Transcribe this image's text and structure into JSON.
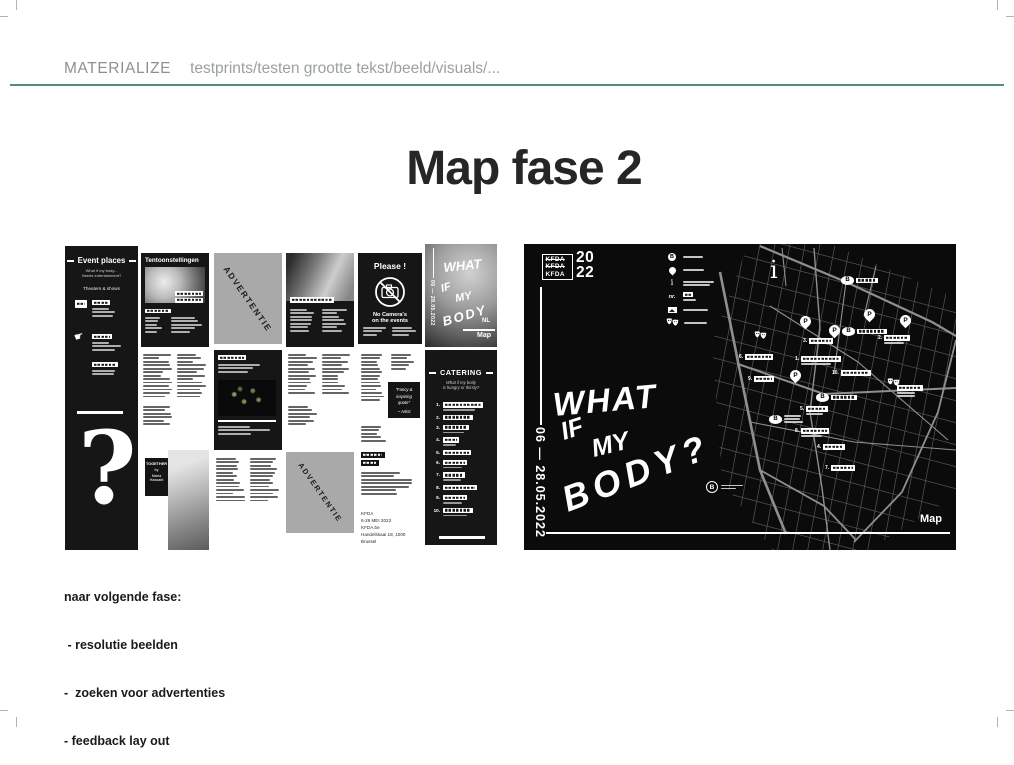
{
  "page": {
    "header": {
      "label": "MATERIALIZE",
      "breadcrumb": "testprints/testen grootte tekst/beeld/visuals/..."
    },
    "title": "Map fase 2",
    "accent_color": "#578c7c",
    "notes": {
      "heading": "naar volgende fase:",
      "items": [
        " - resolutie beelden",
        "-  zoeken voor advertenties",
        "- feedback lay out"
      ]
    }
  },
  "brochure": {
    "event_places": {
      "title": "Event places",
      "subtitle1": "What if my body...",
      "subtitle2": "Needs entertainment?",
      "section": "Theaters & shows",
      "question_mark": "?",
      "hand_glyph": "☛"
    },
    "tentoonstellingen": {
      "title": "Tentoonstellingen"
    },
    "advertentie_label": "ADVERTENTIE",
    "please": {
      "title": "Please !",
      "no_camera_line1": "No Camera's",
      "no_camera_line2": "on the events"
    },
    "cover": {
      "words": [
        "WHAT",
        "IF",
        "MY",
        "BODY"
      ],
      "dates": "06 — 28.05.2022",
      "lang": "NL",
      "map_label": "Map"
    },
    "together": {
      "lines": [
        "TOGETHER",
        "by",
        "Maria",
        "Hassabi"
      ]
    },
    "quote": {
      "line1": "\"Fancy &",
      "line2": "inspiring",
      "line3": "quote\"",
      "author": "~ Artist"
    },
    "catering": {
      "title": "CATERING",
      "subtitle1": "What if my body",
      "subtitle2": "is hungry or thirsty?",
      "numbers": [
        "1.",
        "2.",
        "3.",
        "4.",
        "5.",
        "6.",
        "7.",
        "8.",
        "9.",
        "10."
      ]
    },
    "info": {
      "org": "KFDA",
      "dates": "6-28 MEI 2022",
      "site": "KFDA.be",
      "address": "Handelskaai 18, 1000 Brussel"
    }
  },
  "map_board": {
    "logo": {
      "rows": [
        "KFDA",
        "KFDA",
        "KFDA"
      ],
      "year_top": "20",
      "year_bottom": "22"
    },
    "legend": {
      "items": [
        {
          "icon": "metro-b-icon",
          "glyph": "B",
          "label_style": "bar"
        },
        {
          "icon": "location-pin-icon",
          "label_style": "bar"
        },
        {
          "icon": "info-icon",
          "glyph": "i",
          "label_style": "bars2"
        },
        {
          "icon": "number-icon",
          "glyph": "nr.",
          "label_style": "box"
        },
        {
          "icon": "photo-icon",
          "label_style": "bar"
        },
        {
          "icon": "theater-masks-icon",
          "label_style": "bar"
        }
      ]
    },
    "dates_vertical": "06 — 28.05.2022",
    "handwritten": {
      "words": [
        "WHAT",
        "IF",
        "MY",
        "BODY?"
      ]
    },
    "info_glyph": "i",
    "map_label": "Map",
    "b_logo_glyph": "B",
    "markers": {
      "pin_glyph": "P",
      "stop_glyph": "B",
      "pins": [
        {
          "x": 276,
          "y": 72
        },
        {
          "x": 305,
          "y": 81
        },
        {
          "x": 340,
          "y": 65
        },
        {
          "x": 376,
          "y": 71
        },
        {
          "x": 266,
          "y": 126
        }
      ],
      "stops": [
        {
          "x": 317,
          "y": 32,
          "label_w": 22
        },
        {
          "x": 318,
          "y": 83,
          "label_w": 30
        },
        {
          "x": 292,
          "y": 149,
          "label_w": 26
        },
        {
          "x": 245,
          "y": 171,
          "label_w": 0
        }
      ],
      "numbers": [
        {
          "n": "1.",
          "x": 271,
          "y": 112,
          "w": 40,
          "sub": true
        },
        {
          "n": "2.",
          "x": 354,
          "y": 91,
          "w": 26,
          "sub": true
        },
        {
          "n": "3.",
          "x": 279,
          "y": 94,
          "w": 24,
          "sub": false
        },
        {
          "n": "4.",
          "x": 293,
          "y": 200,
          "w": 22,
          "sub": false
        },
        {
          "n": "5.",
          "x": 276,
          "y": 162,
          "w": 22,
          "sub": true
        },
        {
          "n": "6.",
          "x": 215,
          "y": 110,
          "w": 28,
          "sub": false
        },
        {
          "n": "7.",
          "x": 301,
          "y": 221,
          "w": 24,
          "sub": false
        },
        {
          "n": "8.",
          "x": 271,
          "y": 184,
          "w": 28,
          "sub": true
        },
        {
          "n": "9.",
          "x": 224,
          "y": 132,
          "w": 20,
          "sub": false
        },
        {
          "n": "10.",
          "x": 308,
          "y": 126,
          "w": 30,
          "sub": false
        }
      ],
      "masks": [
        {
          "x": 230,
          "y": 83
        },
        {
          "x": 363,
          "y": 130
        }
      ],
      "extra_labels": [
        {
          "x": 373,
          "y": 141,
          "w": 26
        }
      ]
    }
  }
}
